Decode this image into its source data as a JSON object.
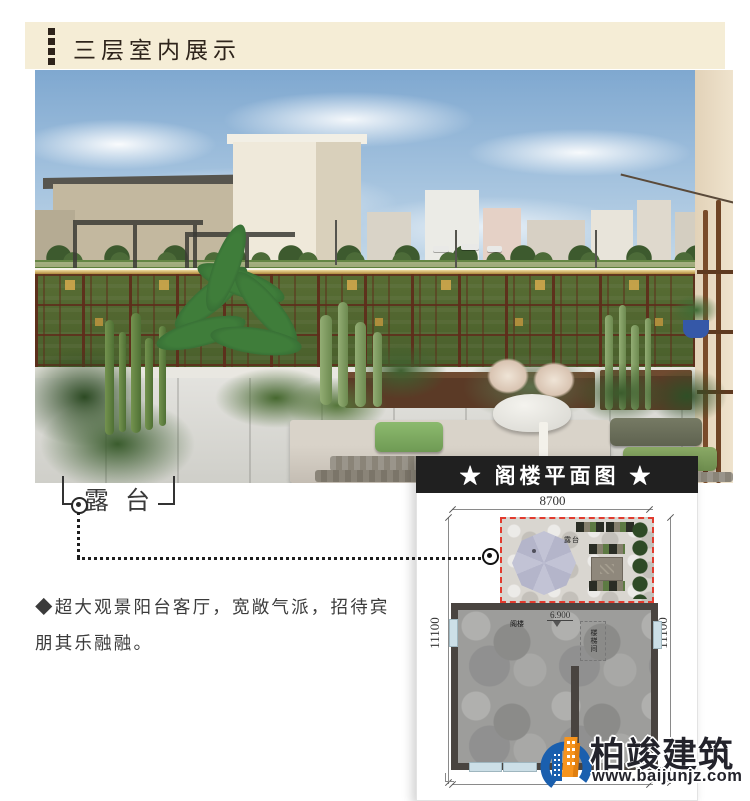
{
  "header": {
    "title": "三层室内展示"
  },
  "annotation": {
    "terrace_label": "露台"
  },
  "note": {
    "line1": "◆超大观景阳台客厅，宽敞气派，招待宾",
    "line2": "朋其乐融融。"
  },
  "floorplan": {
    "title": "★ 阁楼平面图 ★",
    "width_dim": "8700",
    "left_dim": "11100",
    "right_dim": "11100",
    "terrace_label": "露台",
    "room_label": "阁楼",
    "level_label": "6.900",
    "stair_label": "楼梯间"
  },
  "logo": {
    "company": "柏竣建筑",
    "website": "www.baijunjz.com"
  },
  "colors": {
    "header_band": "#f5edd6",
    "accent_dark": "#2e241b",
    "plan_dash_red": "#e23b2e",
    "plan_header_bg": "#202020",
    "logo_blue": "#1a5fae",
    "logo_orange": "#f7941d"
  }
}
